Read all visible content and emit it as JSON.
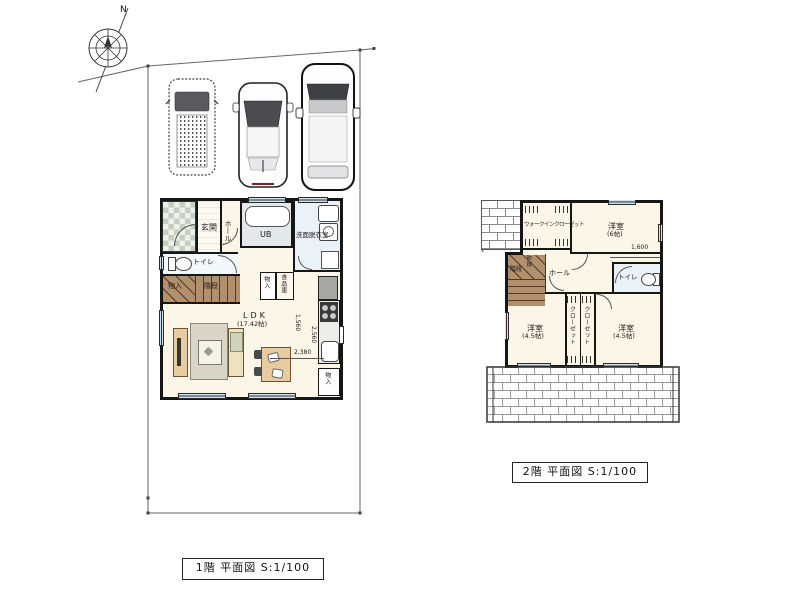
{
  "meta": {
    "compass_n": "N"
  },
  "floor1": {
    "caption": "1階 平面図 S:1/100",
    "labels": {
      "genkan": "玄関",
      "hall": "ホール",
      "ub": "UB",
      "senmen": "洗面脱衣室",
      "toilet": "トイレ",
      "storage_stairs": "物入",
      "stairs": "階段",
      "ldk": "LDK",
      "ldk_size": "(17.42帖)",
      "storage_mid": "物入",
      "pantry": "食品庫",
      "storage_kitchen": "物入",
      "dim_1560": "1,560",
      "dim_2560": "2,560",
      "dim_2380": "2,380"
    }
  },
  "floor2": {
    "caption": "2階 平面図 S:1/100",
    "labels": {
      "wic": "ウォークインクローゼット",
      "bed6": "洋室",
      "bed6_size": "(6帖)",
      "stairs": "階段",
      "void": "吹抜",
      "hall": "ホール",
      "toilet": "トイレ",
      "closet_l": "クローゼット",
      "closet_r": "クローゼット",
      "bed45l": "洋室",
      "bed45l_size": "(4.5帖)",
      "bed45r": "洋室",
      "bed45r_size": "(4.5帖)",
      "dim_1600": "1,600"
    }
  },
  "colors": {
    "wall": "#161616",
    "floor": "#fcf6e8",
    "porch_tile": "#c6cec2",
    "bath": "#e3e8ea",
    "washroom": "#eaf2f8",
    "window": "#cfe4f3",
    "stairs_wood": "#b2906b",
    "furniture": "#e9cba2",
    "rug": "#d9d5c7",
    "counter": "#ececea",
    "appliance_gray": "#a7a7a3",
    "boundary_line": "#666666"
  }
}
